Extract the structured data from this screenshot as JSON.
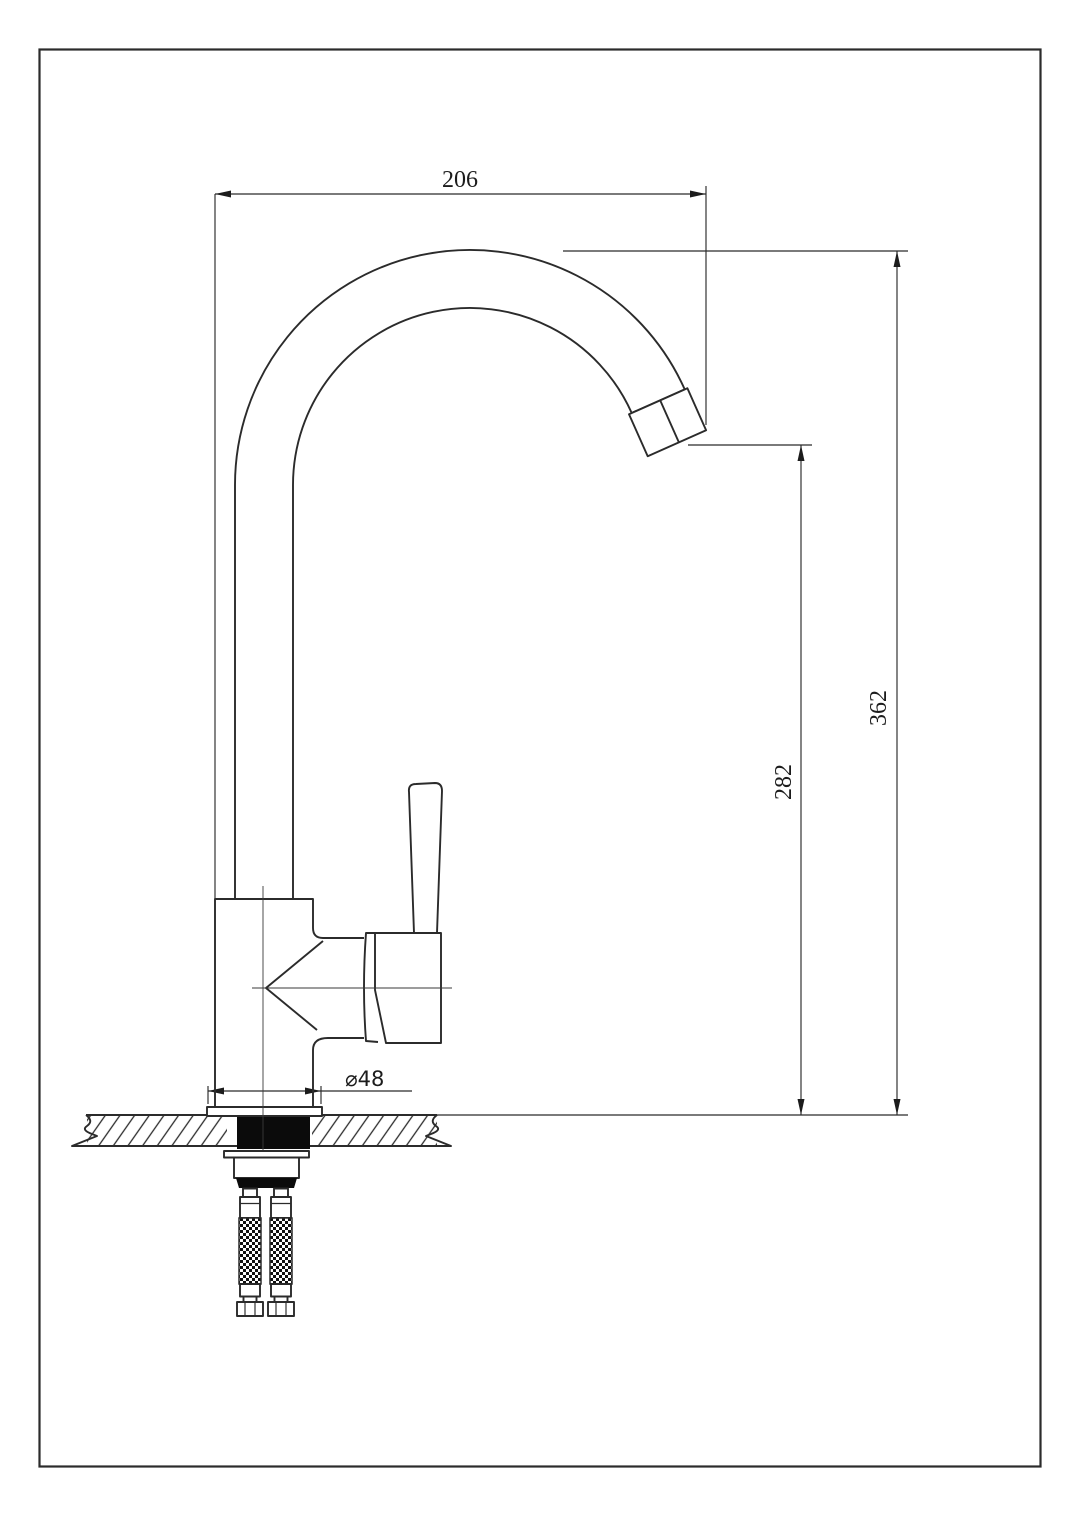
{
  "drawing": {
    "labels": {
      "dim_top_width": "206",
      "dim_right_outer_height": "362",
      "dim_right_inner_height": "282",
      "dim_base_diameter": "⌀48"
    },
    "colors": {
      "background": "#ffffff",
      "line": "#2b2b2b",
      "solid_fill": "#0b0b0b",
      "text": "#1c1c1c"
    }
  }
}
